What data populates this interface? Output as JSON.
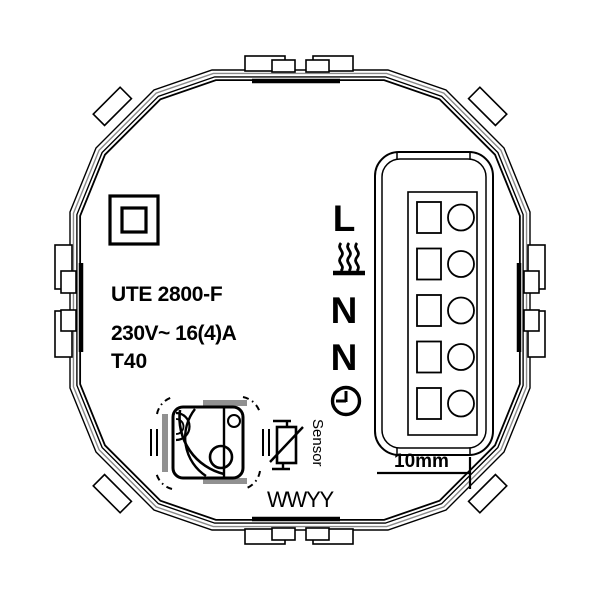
{
  "device": {
    "model": "UTE 2800-F",
    "rating": "230V~ 16(4)A",
    "temperature_class": "T40",
    "date_code": "WWYY"
  },
  "terminals": {
    "rows": [
      {
        "label": "L",
        "icon": "live-terminal"
      },
      {
        "label": "",
        "icon": "heating-icon"
      },
      {
        "label": "N",
        "icon": "neutral-terminal"
      },
      {
        "label": "N",
        "icon": "neutral-terminal"
      },
      {
        "label": "",
        "icon": "clock-icon"
      }
    ]
  },
  "sensor": {
    "label": "Sensor"
  },
  "dimension": {
    "label": "10mm"
  },
  "icons": {
    "class2_insulation": "square-in-square",
    "heating": "wavy-lines-over-bar",
    "timer": "clock-face"
  },
  "colors": {
    "line": "#000000",
    "shade": "#919191",
    "background": "#ffffff"
  }
}
